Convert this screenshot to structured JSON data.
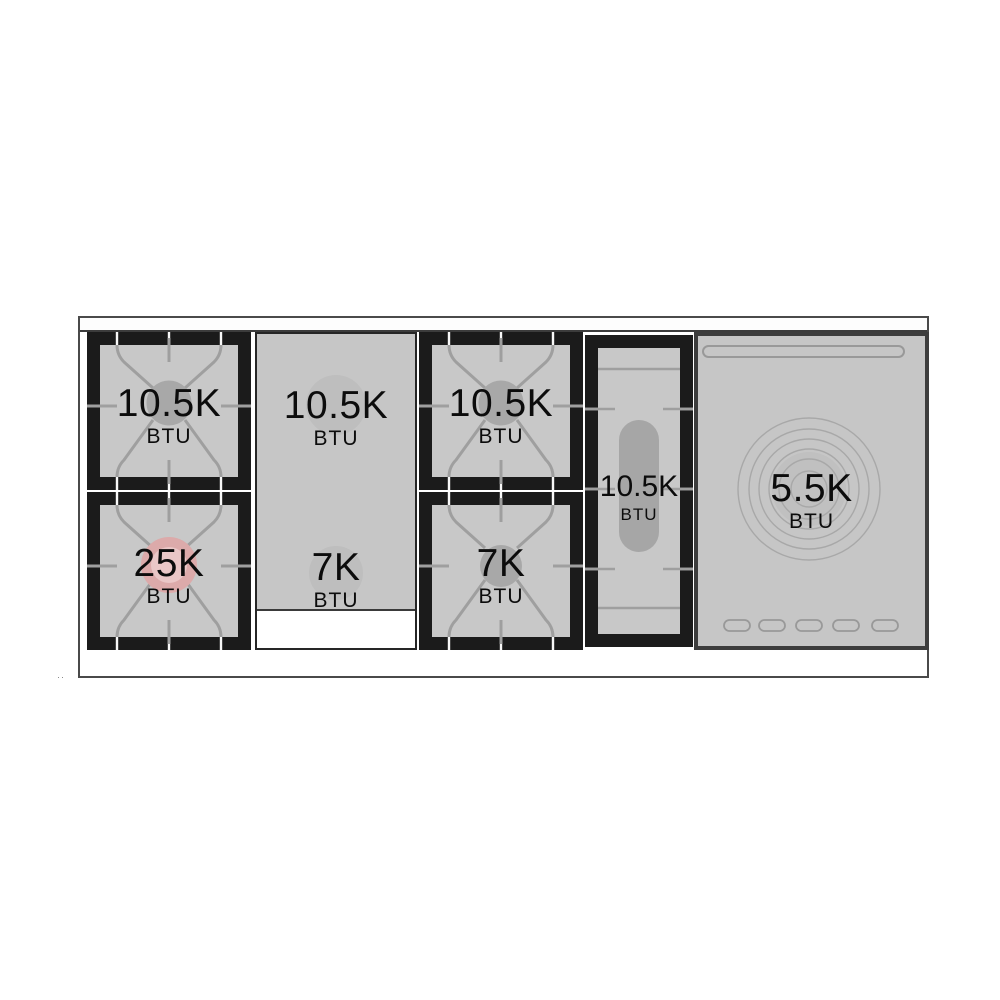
{
  "modules": {
    "left": {
      "top": {
        "power": "10.5K",
        "unit": "BTU"
      },
      "bottom": {
        "power": "25K",
        "unit": "BTU"
      }
    },
    "griddle": {
      "top": {
        "power": "10.5K",
        "unit": "BTU"
      },
      "bottom": {
        "power": "7K",
        "unit": "BTU"
      }
    },
    "middle": {
      "top": {
        "power": "10.5K",
        "unit": "BTU"
      },
      "bottom": {
        "power": "7K",
        "unit": "BTU"
      }
    },
    "oval": {
      "power": "10.5K",
      "unit": "BTU"
    },
    "warming": {
      "power": "5.5K",
      "unit": "BTU"
    }
  },
  "colors": {
    "surface_gray": "#c8c8c8",
    "frame_black": "#1b1b1b",
    "grate_line": "#9f9f9f",
    "burner_cap_gray": "#a8a8a8",
    "power_burner_outer_pink": "#dcaaaa",
    "power_burner_inner_pink": "#eac7c7",
    "outline_gray": "#4a4a4a"
  },
  "stray_mark": "··"
}
